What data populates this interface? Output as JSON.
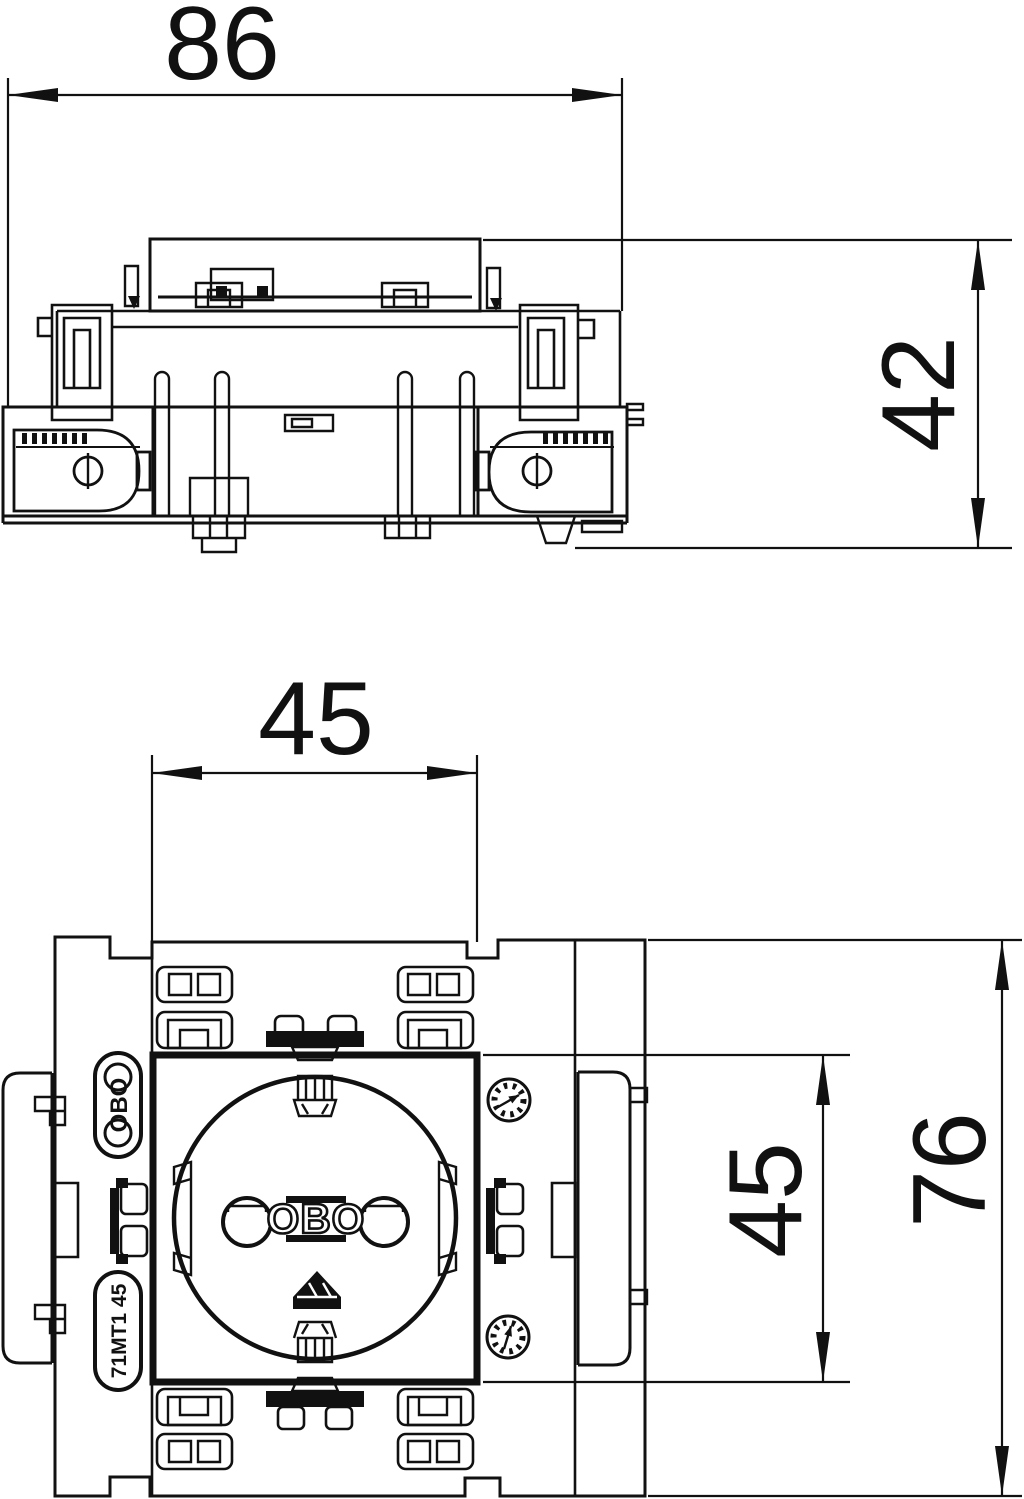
{
  "drawing": {
    "ink": "#111111",
    "background": "#ffffff"
  },
  "top_view": {
    "dim_width": "86",
    "dim_height": "42"
  },
  "front_view": {
    "dim_module_width": "45",
    "dim_module_height": "45",
    "dim_total_height": "76",
    "brand_badge_text": "OBO",
    "socket_logo_text": "OBO",
    "model_badge_text": "71MT1 45"
  }
}
